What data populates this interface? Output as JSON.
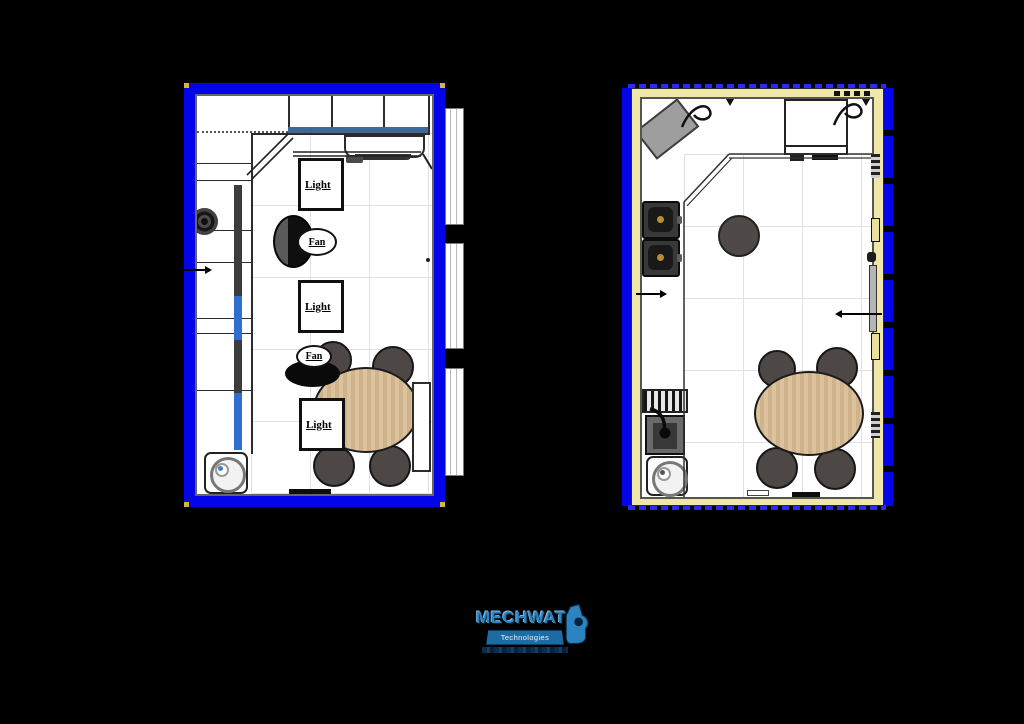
{
  "labels": {
    "light": "Light",
    "fan": "Fan"
  },
  "logo": {
    "title": "MECHWAT",
    "subtitle": "Technologies"
  },
  "colors": {
    "background": "#000000",
    "wall_blue": "#0404e8",
    "wall_yellow": "#efe7a9",
    "table_wood": "#d9bd97",
    "chair_gray": "#4d4845",
    "logo_blue": "#2b83c0",
    "corner_dot_gold": "#d9b43a"
  },
  "plan_left": {
    "light_labels": [
      "Light",
      "Light",
      "Light"
    ],
    "fan_labels": [
      "Fan",
      "Fan"
    ]
  },
  "plan_right": {
    "annotation_arrows": 2
  }
}
